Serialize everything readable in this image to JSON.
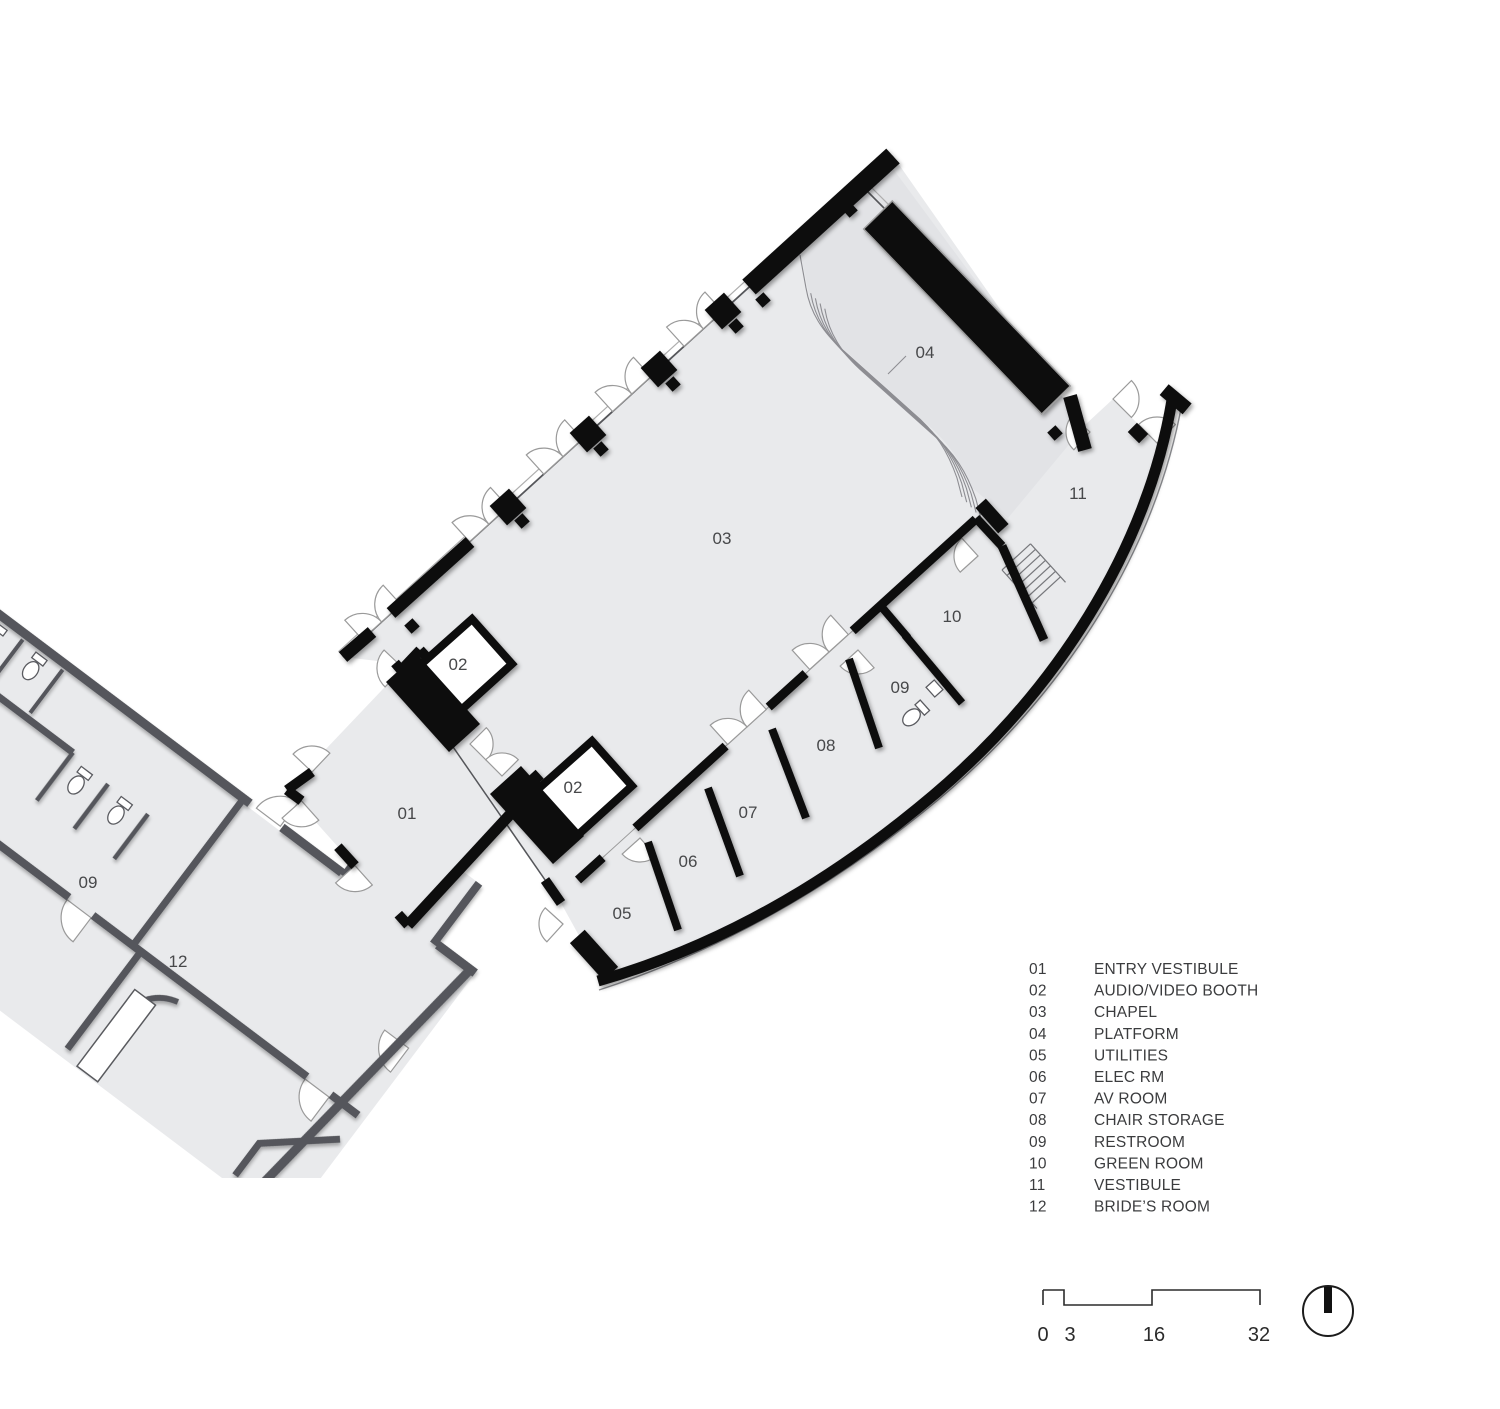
{
  "title": "Chapel floor plan",
  "plan": {
    "room_labels": [
      {
        "id": "01",
        "x": 407,
        "y": 819
      },
      {
        "id": "02",
        "x": 458,
        "y": 670
      },
      {
        "id": "02",
        "x": 573,
        "y": 793
      },
      {
        "id": "03",
        "x": 722,
        "y": 544
      },
      {
        "id": "04",
        "x": 925,
        "y": 358
      },
      {
        "id": "05",
        "x": 622,
        "y": 919
      },
      {
        "id": "06",
        "x": 688,
        "y": 867
      },
      {
        "id": "07",
        "x": 748,
        "y": 818
      },
      {
        "id": "08",
        "x": 826,
        "y": 751
      },
      {
        "id": "09",
        "x": 900,
        "y": 693
      },
      {
        "id": "10",
        "x": 952,
        "y": 622
      },
      {
        "id": "11",
        "x": 1078,
        "y": 499
      },
      {
        "id": "09",
        "x": 88,
        "y": 888
      },
      {
        "id": "12",
        "x": 178,
        "y": 967
      }
    ]
  },
  "legend": {
    "items": [
      {
        "num": "01",
        "label": "ENTRY VESTIBULE"
      },
      {
        "num": "02",
        "label": "AUDIO/VIDEO BOOTH"
      },
      {
        "num": "03",
        "label": "CHAPEL"
      },
      {
        "num": "04",
        "label": "PLATFORM"
      },
      {
        "num": "05",
        "label": "UTILITIES"
      },
      {
        "num": "06",
        "label": "ELEC RM"
      },
      {
        "num": "07",
        "label": "AV ROOM"
      },
      {
        "num": "08",
        "label": "CHAIR STORAGE"
      },
      {
        "num": "09",
        "label": "RESTROOM"
      },
      {
        "num": "10",
        "label": "GREEN ROOM"
      },
      {
        "num": "11",
        "label": "VESTIBULE"
      },
      {
        "num": "12",
        "label": "BRIDE’S ROOM"
      }
    ]
  },
  "scale_bar": {
    "ticks": [
      "0",
      "3",
      "16",
      "32"
    ]
  },
  "icons": {
    "north_arrow": "north-arrow"
  },
  "colors": {
    "new_wall": "#0b0b0c",
    "existing_wall": "#55565b",
    "floor": "#e9eaec",
    "platform_floor": "#e2e3e6",
    "door_arc": "#9a9a9a",
    "text": "#3b3c3e"
  }
}
